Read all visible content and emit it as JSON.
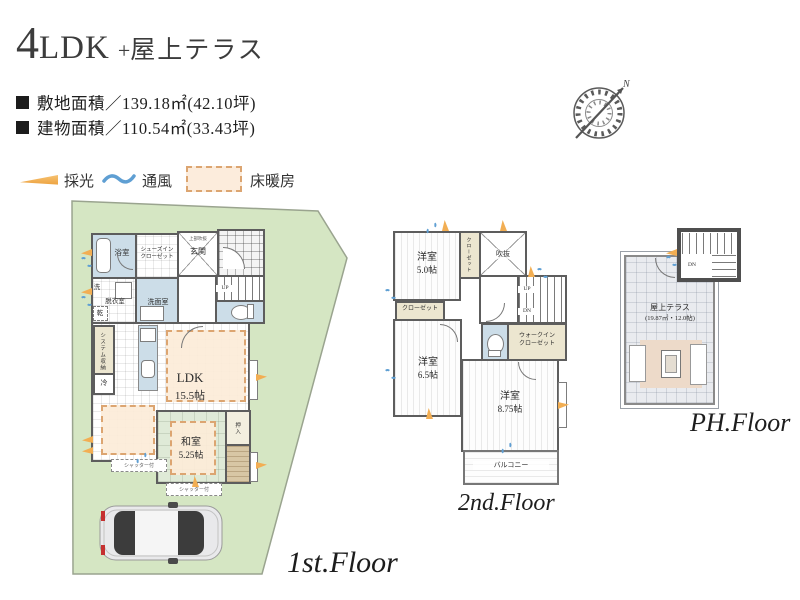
{
  "header": {
    "title": {
      "num": "4",
      "ldk": "LDK",
      "plus": "+",
      "suffix": "屋上テラス"
    },
    "site_area": "敷地面積／139.18㎡(42.10坪)",
    "building_area": "建物面積／110.54㎡(33.43坪)"
  },
  "legend": {
    "daylight": "採光",
    "ventilation": "通風",
    "floor_heating": "床暖房"
  },
  "compass": {
    "north": "N"
  },
  "floor1": {
    "label": "1st.Floor",
    "bath": "浴室",
    "shoes_closet_l1": "シューズイン",
    "shoes_closet_l2": "クローゼット",
    "entrance": "玄関",
    "entrance_note": "上部吹抜",
    "washer": "洗",
    "dryer": "乾",
    "dressing": "脱衣室",
    "washroom": "洗面室",
    "up": "UP",
    "storage": "システム収納",
    "fridge": "冷",
    "ldk_name": "LDK",
    "ldk_size": "15.5帖",
    "washitsu_name": "和室",
    "washitsu_size": "5.25帖",
    "oshiire": "押入",
    "shutter": "シャッター付"
  },
  "floor2": {
    "label": "2nd.Floor",
    "bedroom1_name": "洋室",
    "bedroom1_size": "5.0帖",
    "closet_vertical": "クローゼット",
    "void": "吹抜",
    "up": "UP",
    "dn": "DN",
    "closet": "クローゼット",
    "wic_l1": "ウォークイン",
    "wic_l2": "クローゼット",
    "bedroom2_name": "洋室",
    "bedroom2_size": "6.5帖",
    "bedroom3_name": "洋室",
    "bedroom3_size": "8.75帖",
    "balcony": "バルコニー"
  },
  "floorPH": {
    "label": "PH.Floor",
    "dn": "DN",
    "terrace_name": "屋上テラス",
    "terrace_size": "(19.87㎡・12.0帖)"
  },
  "colors": {
    "site_green": "#d5e6c3",
    "wall": "#5d5d5d",
    "wet_room_blue": "#ccdde8",
    "closet_beige": "#ece6d0",
    "tatami_green": "#dfead7",
    "floor_heating_fill": "#fcecdc",
    "floor_heating_border": "#dca571",
    "daylight_orange": "#f2ae53",
    "ventilation_blue": "#5f9fd3",
    "deck_wood": "#d8c7a5",
    "terrace_tile": "#e9ebef",
    "rug": "#eddac9"
  }
}
